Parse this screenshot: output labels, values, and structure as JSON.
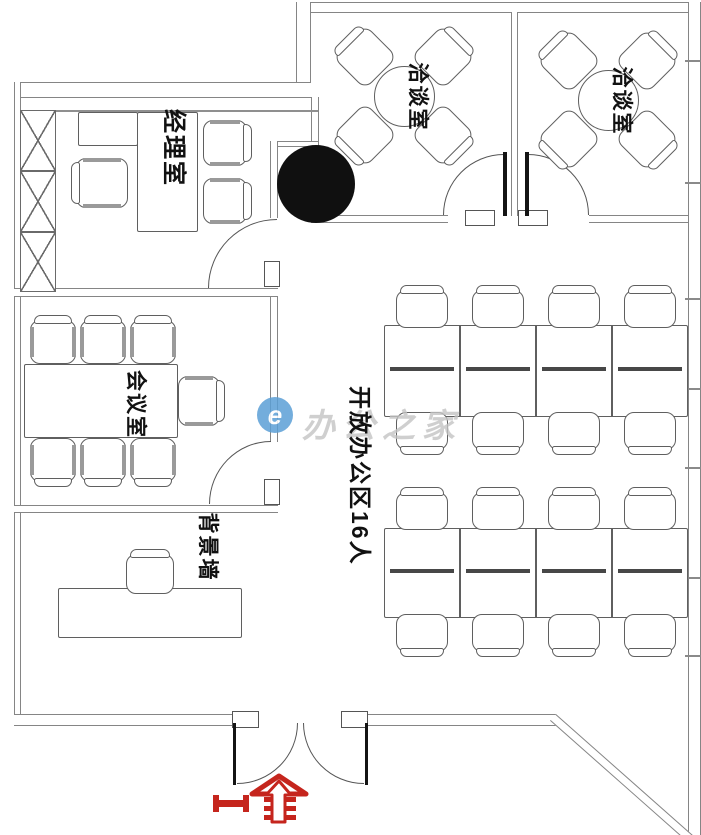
{
  "plan": {
    "title": "office-floor-plan",
    "labels": {
      "manager_office": "经理室",
      "meeting_room_1": "洽谈室",
      "meeting_room_2": "洽谈室",
      "conference_room": "会议室",
      "open_office": "开放办公区16人",
      "feature_wall": "背景墙"
    },
    "open_office_seats": 16,
    "watermark": {
      "text": "办公之家",
      "logo_letter": "e"
    },
    "colors": {
      "wall": "#858585",
      "furniture_line": "#5f5f5f",
      "label_text": "#111111",
      "watermark_text": "#c4c4c4",
      "watermark_logo_blue": "#5b9fd6",
      "brand_red": "#c5251d",
      "black_marker": "#101010",
      "background": "#ffffff"
    }
  }
}
